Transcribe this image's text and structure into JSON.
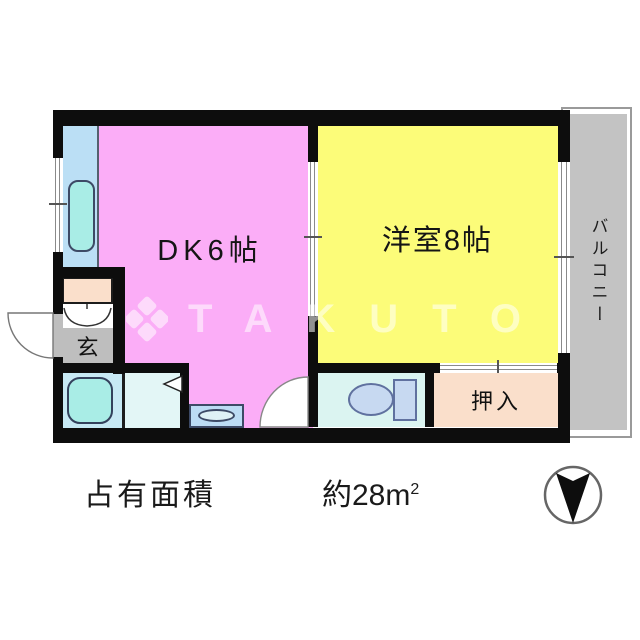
{
  "rooms": {
    "dk": {
      "label": "DK6帖"
    },
    "western": {
      "label": "洋室8帖"
    },
    "balcony": {
      "label": "バルコニー"
    },
    "genkan": {
      "label": "玄"
    },
    "closet": {
      "label": "押入"
    }
  },
  "footer": {
    "area_label": "占有面積",
    "area_value": "約28m",
    "area_sup": "2"
  },
  "watermark": {
    "text": "TAKUTO"
  },
  "icons": {
    "compass": "compass-needle-icon",
    "entrance_door": "door-swing-icon",
    "toilet_door": "door-swing-icon",
    "washroom_door": "door-arrow-icon",
    "toilet": "toilet-icon",
    "bathtub": "bathtub-icon",
    "kitchen_sink": "kitchen-sink-icon",
    "washer_pan": "washer-pan-icon",
    "closet_front": "folding-door-icon"
  },
  "colors": {
    "dk": "#fbadf7",
    "western": "#fcfc79",
    "balcony": "#c3c3c3",
    "genkan": "#bebebe",
    "closet": "#fadfcb",
    "kitchen": "#bbdff5",
    "bathroom": "#c7e9f4",
    "washroom": "#e3f6f6",
    "toilet_room": "#dbf4f1",
    "fixture_cyan": "#a9ede6",
    "fixture_blue": "#c7d9f1",
    "wall": "#0d0d0d"
  }
}
